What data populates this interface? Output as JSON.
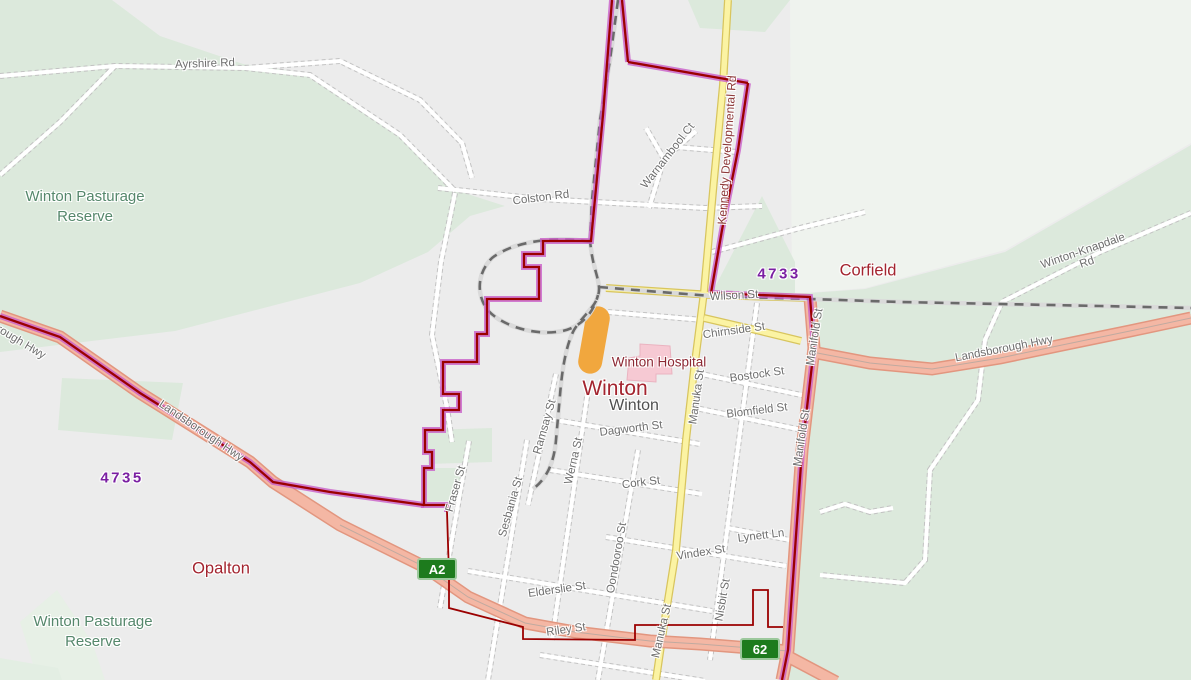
{
  "map": {
    "colors": {
      "urban_base": "#ececec",
      "reserve_green": "#dce9dc",
      "pale_green": "#eff3ee",
      "road_yellow": "#fbf3a3",
      "highway_salmon": "#f4b7a4",
      "boundary_magenta": "#c95fc9",
      "boundary_red": "#9b0000",
      "railway_gray": "#6a6a6a",
      "highlight_orange": "#f1a73e",
      "hospital_pink": "#f6c9d3",
      "shield_green": "#1d7b1d",
      "postcode_purple": "#7a1fa2",
      "locality_red": "#a3242f",
      "reserve_label_green": "#55876b"
    },
    "labels": [
      {
        "id": "ayrshire-rd",
        "text": "Ayrshire Rd",
        "x": 205,
        "y": 64,
        "rot": -2,
        "cls": "road"
      },
      {
        "id": "colston-rd",
        "text": "Colston Rd",
        "x": 541,
        "y": 198,
        "rot": -7,
        "cls": "road"
      },
      {
        "id": "warnambool-ct",
        "text": "Warnambool Ct",
        "x": 668,
        "y": 156,
        "rot": -52,
        "cls": "road"
      },
      {
        "id": "kennedy-developmental-rd",
        "text": "Kennedy Developmental Rd",
        "x": 727,
        "y": 150,
        "rot": -86,
        "cls": "road-maroon"
      },
      {
        "id": "winton-knapdale-rd",
        "text": "Winton-Knapdale Rd",
        "x": 1085,
        "y": 257,
        "rot": -19,
        "cls": "road"
      },
      {
        "id": "wilson-st",
        "text": "Wilson St",
        "x": 734,
        "y": 296,
        "rot": -3,
        "cls": "road"
      },
      {
        "id": "chirnside-st",
        "text": "Chirnside St",
        "x": 734,
        "y": 331,
        "rot": -8,
        "cls": "road"
      },
      {
        "id": "bostock-st",
        "text": "Bostock St",
        "x": 757,
        "y": 375,
        "rot": -8,
        "cls": "road"
      },
      {
        "id": "blomfield-st",
        "text": "Blomfield St",
        "x": 757,
        "y": 411,
        "rot": -7,
        "cls": "road"
      },
      {
        "id": "dagworth-st",
        "text": "Dagworth St",
        "x": 631,
        "y": 429,
        "rot": -7,
        "cls": "road"
      },
      {
        "id": "cork-st",
        "text": "Cork St",
        "x": 641,
        "y": 483,
        "rot": -7,
        "cls": "road"
      },
      {
        "id": "vindex-st",
        "text": "Vindex St",
        "x": 701,
        "y": 553,
        "rot": -9,
        "cls": "road"
      },
      {
        "id": "lynett-ln",
        "text": "Lynett Ln",
        "x": 761,
        "y": 536,
        "rot": -7,
        "cls": "road"
      },
      {
        "id": "elderslie-st",
        "text": "Elderslie St",
        "x": 557,
        "y": 590,
        "rot": -8,
        "cls": "road"
      },
      {
        "id": "riley-st",
        "text": "Riley St",
        "x": 566,
        "y": 630,
        "rot": -8,
        "cls": "road"
      },
      {
        "id": "fraser-st",
        "text": "Fraser St",
        "x": 456,
        "y": 489,
        "rot": -74,
        "cls": "road"
      },
      {
        "id": "sesbania-st",
        "text": "Sesbania St",
        "x": 511,
        "y": 507,
        "rot": -74,
        "cls": "road"
      },
      {
        "id": "ramsay-st",
        "text": "Ramsay St",
        "x": 545,
        "y": 427,
        "rot": -74,
        "cls": "road"
      },
      {
        "id": "werna-st",
        "text": "Werna St",
        "x": 574,
        "y": 461,
        "rot": -77,
        "cls": "road"
      },
      {
        "id": "oondooroo-st",
        "text": "Oondooroo St",
        "x": 617,
        "y": 558,
        "rot": -80,
        "cls": "road"
      },
      {
        "id": "manuka-st-north",
        "text": "Manuka St",
        "x": 697,
        "y": 397,
        "rot": -82,
        "cls": "road"
      },
      {
        "id": "manuka-st-south",
        "text": "Manuka St",
        "x": 662,
        "y": 631,
        "rot": -77,
        "cls": "road"
      },
      {
        "id": "nisbit-st",
        "text": "Nisbit St",
        "x": 723,
        "y": 600,
        "rot": -80,
        "cls": "road"
      },
      {
        "id": "manifold-st-north",
        "text": "Manifold St",
        "x": 815,
        "y": 337,
        "rot": -81,
        "cls": "road"
      },
      {
        "id": "manifold-st-south",
        "text": "Manifold St",
        "x": 802,
        "y": 438,
        "rot": -81,
        "cls": "road"
      },
      {
        "id": "landsborough-hwy-west1",
        "text": "Landsborough Hwy",
        "x": 2,
        "y": 331,
        "rot": 31,
        "cls": "road"
      },
      {
        "id": "landsborough-hwy-west2",
        "text": "Landsborough Hwy",
        "x": 201,
        "y": 431,
        "rot": 34,
        "cls": "road"
      },
      {
        "id": "landsborough-hwy-east",
        "text": "Landsborough Hwy",
        "x": 1004,
        "y": 349,
        "rot": -11,
        "cls": "road"
      },
      {
        "id": "corfield",
        "text": "Corfield",
        "x": 868,
        "y": 271,
        "rot": 0,
        "cls": "locality"
      },
      {
        "id": "opalton",
        "text": "Opalton",
        "x": 221,
        "y": 569,
        "rot": 0,
        "cls": "locality"
      },
      {
        "id": "winton-locality",
        "text": "Winton",
        "x": 615,
        "y": 389,
        "rot": 0,
        "cls": "locality-big"
      },
      {
        "id": "winton-town",
        "text": "Winton",
        "x": 634,
        "y": 406,
        "rot": 0,
        "cls": "town"
      },
      {
        "id": "winton-hospital",
        "text": "Winton Hospital",
        "x": 659,
        "y": 362,
        "rot": 0,
        "cls": "poi"
      },
      {
        "id": "postcode-4733",
        "text": "4733",
        "x": 779,
        "y": 274,
        "rot": 0,
        "cls": "postcode"
      },
      {
        "id": "postcode-4735",
        "text": "4735",
        "x": 122,
        "y": 478,
        "rot": 0,
        "cls": "postcode"
      },
      {
        "id": "winton-pasturage-reserve-north",
        "text": "Winton Pasturage\nReserve",
        "x": 85,
        "y": 207,
        "rot": 0,
        "cls": "reserve"
      },
      {
        "id": "winton-pasturage-reserve-south",
        "text": "Winton Pasturage\nReserve",
        "x": 93,
        "y": 632,
        "rot": 0,
        "cls": "reserve"
      }
    ],
    "shields": [
      {
        "id": "route-a2",
        "text": "A2",
        "x": 417,
        "y": 558
      },
      {
        "id": "route-62",
        "text": "62",
        "x": 740,
        "y": 638
      }
    ]
  }
}
